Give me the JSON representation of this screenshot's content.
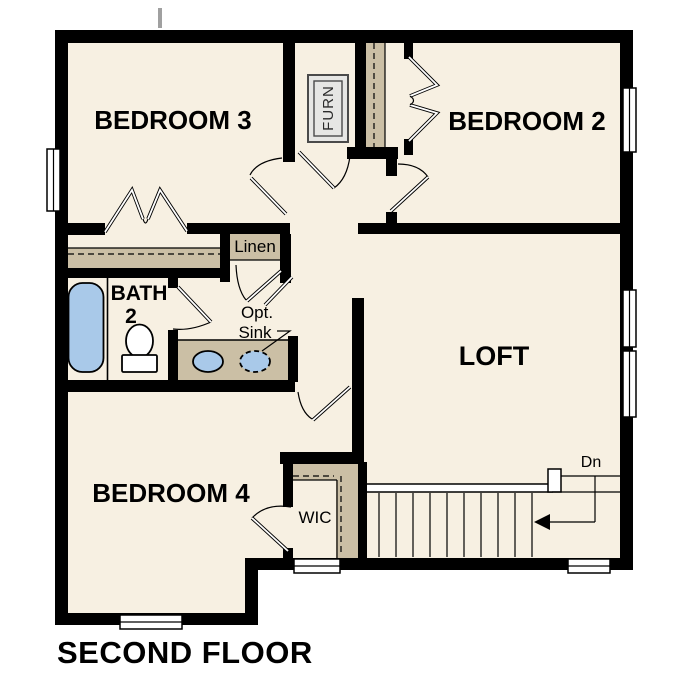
{
  "title": "SECOND FLOOR",
  "rooms": {
    "bedroom3": "BEDROOM 3",
    "bedroom2": "BEDROOM 2",
    "bedroom4": "BEDROOM 4",
    "loft": "LOFT",
    "bath": {
      "line1": "BATH",
      "line2": "2"
    },
    "wic": "WIC",
    "linen": "Linen",
    "furnace": "FURN"
  },
  "annotations": {
    "opt_sink_line1": "Opt.",
    "opt_sink_line2": "Sink",
    "stairs_direction": "Dn"
  },
  "colors": {
    "floor": "#f7f0e2",
    "wall": "#000000",
    "closet": "#cbbfa5",
    "fixture": "#a9c9e9",
    "furnace": "#e6e6e4",
    "bg": "#ffffff"
  }
}
